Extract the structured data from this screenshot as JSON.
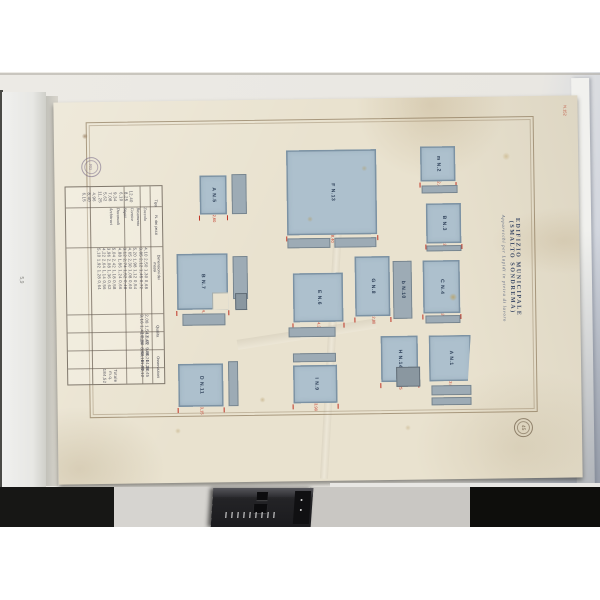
{
  "title": {
    "line1": "EDIFIZIO MUNICIPALE (SMALTO SONDREMA)",
    "line2": "Apparecchi per Lapidi in pietra di lavoro"
  },
  "notes": {
    "corner_note": "N.152",
    "pencil_note": "5,9",
    "stamp_top_left": "RG",
    "stamp_bottom_right": "45"
  },
  "colors": {
    "letterbox": "#ffffff",
    "backdrop": "#e9e7e2",
    "backdrop_right": "#bcc2cd",
    "paper": "#e9e2cf",
    "wash_blue": "#adc0cd",
    "wash_grey": "#9dabb5",
    "dim_red": "#c03425",
    "ink_navy": "#2e4059",
    "shelf_black": "#121210"
  },
  "figures": [
    {
      "k": "fig",
      "x": 145,
      "y": 75,
      "w": 27,
      "h": 39,
      "letter": "A",
      "no": "N.5",
      "dims": "2,60"
    },
    {
      "k": "strip",
      "x": 177,
      "y": 74,
      "w": 15,
      "h": 40
    },
    {
      "k": "fig",
      "x": 121,
      "y": 153,
      "w": 51,
      "h": 56,
      "letter": "B",
      "no": "N.7",
      "dims": "4,10",
      "notch": true
    },
    {
      "k": "strip",
      "x": 177,
      "y": 156,
      "w": 15,
      "h": 43
    },
    {
      "k": "dark",
      "x": 179,
      "y": 193,
      "w": 12,
      "h": 17
    },
    {
      "k": "strip",
      "x": 126,
      "y": 213,
      "w": 43,
      "h": 12
    },
    {
      "k": "fig",
      "x": 121,
      "y": 263,
      "w": 45,
      "h": 43,
      "letter": "D",
      "no": "N.11",
      "dims": "3,15"
    },
    {
      "k": "strip",
      "x": 171,
      "y": 261,
      "w": 10,
      "h": 45
    },
    {
      "k": "fig",
      "x": 232,
      "y": 51,
      "w": 90,
      "h": 85,
      "letter": "F",
      "no": "N.13",
      "dims": "8,40"
    },
    {
      "k": "strip",
      "x": 232,
      "y": 139,
      "w": 43,
      "h": 10
    },
    {
      "k": "strip",
      "x": 279,
      "y": 139,
      "w": 42,
      "h": 10
    },
    {
      "k": "fig",
      "x": 237,
      "y": 174,
      "w": 50,
      "h": 49,
      "letter": "E",
      "no": "N.6",
      "dims": "4,35"
    },
    {
      "k": "strip",
      "x": 232,
      "y": 228,
      "w": 47,
      "h": 10
    },
    {
      "k": "strip",
      "x": 236,
      "y": 254,
      "w": 43,
      "h": 9
    },
    {
      "k": "fig",
      "x": 236,
      "y": 266,
      "w": 44,
      "h": 38,
      "letter": "I",
      "no": "N.9",
      "dims": "3,90"
    },
    {
      "k": "fig",
      "x": 299,
      "y": 158,
      "w": 35,
      "h": 60,
      "letter": "G",
      "no": "N.8",
      "dims": "2,80"
    },
    {
      "k": "strip",
      "x": 337,
      "y": 163,
      "w": 19,
      "h": 58,
      "letter": "b",
      "no": "N.10"
    },
    {
      "k": "fig",
      "x": 324,
      "y": 238,
      "w": 37,
      "h": 46,
      "letter": "H",
      "no": "N.14",
      "dims": "3,25"
    },
    {
      "k": "dark",
      "x": 339,
      "y": 269,
      "w": 24,
      "h": 20
    },
    {
      "k": "fig",
      "x": 366,
      "y": 49,
      "w": 35,
      "h": 35,
      "letter": "m",
      "no": "N.2",
      "dims": "2,45"
    },
    {
      "k": "strip",
      "x": 367,
      "y": 88,
      "w": 36,
      "h": 8
    },
    {
      "k": "fig",
      "x": 371,
      "y": 106,
      "w": 35,
      "h": 40,
      "letter": "B",
      "no": "N.3",
      "dims": "2,90"
    },
    {
      "k": "strip",
      "x": 371,
      "y": 148,
      "w": 35,
      "h": 6
    },
    {
      "k": "fig",
      "x": 367,
      "y": 163,
      "w": 37,
      "h": 53,
      "letter": "C",
      "no": "N.4",
      "dims": "3,45"
    },
    {
      "k": "strip",
      "x": 369,
      "y": 218,
      "w": 35,
      "h": 8
    },
    {
      "k": "fig",
      "x": 372,
      "y": 238,
      "w": 42,
      "h": 46,
      "letter": "A",
      "no": "N.1",
      "dims": "3,60",
      "slant": true
    },
    {
      "k": "strip",
      "x": 374,
      "y": 288,
      "w": 40,
      "h": 10
    },
    {
      "k": "strip",
      "x": 374,
      "y": 300,
      "w": 40,
      "h": 8
    }
  ],
  "table": {
    "geom": {
      "x": 10,
      "y": 84,
      "w": 96,
      "h": 197
    },
    "vlines": [
      24,
      58,
      74,
      84
    ],
    "hlines": [
      20,
      60,
      127,
      145,
      163,
      181
    ],
    "headers": [
      {
        "label": "Tipo",
        "y": 2
      },
      {
        "label": "N. dei pezzi",
        "y": 24
      },
      {
        "label": "Dimensioni dei massi",
        "y": 66
      },
      {
        "label": "Qualita",
        "y": 130
      },
      {
        "label": "Osservazioni",
        "y": 166
      }
    ],
    "bands": [
      {
        "x": 2,
        "y": 1,
        "w": 80,
        "h": 18,
        "style": "tnum",
        "lines": [
          "12,40  8,25  6,10  9,34  7,08  5,62  11,25  4,96  8,40  6,15"
        ]
      },
      {
        "x": 26,
        "y": 21,
        "w": 56,
        "h": 38,
        "style": "tname",
        "lines": [
          "Zoccolo",
          "Basamento",
          "Cornice",
          "Stipiti",
          "Davanzali",
          "Architravi"
        ]
      },
      {
        "x": 2,
        "y": 61,
        "w": 80,
        "h": 64,
        "style": "tnum",
        "lines": [
          "4,10 2,50 1,30 0,68",
          "3,85 2,12 1,45 0,72",
          "5,20 1,98 1,12 0,54",
          "4,65 2,30 1,08 0,60",
          "3,12 2,74 1,52 0,48",
          "4,88 1,86 1,24 0,66",
          "5,04 2,42 1,18 0,58",
          "3,96 2,08 1,36 0,62",
          "4,22 2,64 1,14 0,56",
          "5,10 1,92 1,28 0,64"
        ]
      },
      {
        "x": 26,
        "y": 128,
        "w": 56,
        "h": 16,
        "style": "tnum",
        "lines": [
          "2,08 1,54 0,92",
          "3,16 1,42 0,84"
        ]
      },
      {
        "x": 2,
        "y": 146,
        "w": 80,
        "h": 16,
        "style": "tnum",
        "lines": [
          "12,45  9,80  14,20",
          "10,36  8,64  11,72"
        ]
      },
      {
        "x": 26,
        "y": 164,
        "w": 56,
        "h": 16,
        "style": "tnum",
        "lines": [
          "48,20  36,45",
          "52,18  40,12"
        ]
      },
      {
        "x": 2,
        "y": 182,
        "w": 80,
        "h": 14,
        "style": "tnum",
        "lines": [
          "Totale  m.q. 184,52"
        ]
      }
    ]
  },
  "stains": [
    {
      "x": 31,
      "y": 34,
      "r": 3,
      "c": "rgba(120,85,50,.55)"
    },
    {
      "x": 397,
      "y": 200,
      "r": 4,
      "c": "rgba(190,150,60,.6)"
    },
    {
      "x": 255,
      "y": 120,
      "r": 3,
      "c": "rgba(180,150,80,.45)"
    },
    {
      "x": 310,
      "y": 70,
      "r": 3,
      "c": "rgba(180,150,80,.4)"
    },
    {
      "x": 205,
      "y": 300,
      "r": 3,
      "c": "rgba(170,140,80,.4)"
    },
    {
      "x": 452,
      "y": 60,
      "r": 4,
      "c": "rgba(185,155,90,.4)"
    },
    {
      "x": 120,
      "y": 330,
      "r": 3,
      "c": "rgba(170,140,80,.35)"
    },
    {
      "x": 350,
      "y": 330,
      "r": 3,
      "c": "rgba(170,140,80,.3)"
    }
  ],
  "shelf": {
    "segments": [
      {
        "x": 0,
        "w": 114,
        "c": "#171715"
      },
      {
        "x": 114,
        "w": 100,
        "c": "#d6d4d0"
      },
      {
        "x": 310,
        "w": 160,
        "c": "#c9c7c3"
      },
      {
        "x": 470,
        "w": 130,
        "c": "#0e0e0c"
      }
    ],
    "white_ledge": {
      "x": 330,
      "w": 270,
      "c": "#e8e7e4"
    }
  },
  "device_icons": [
    "knob-icon",
    "knob-icon",
    "ruler-scale-icon",
    "indicator-dots-icon"
  ]
}
